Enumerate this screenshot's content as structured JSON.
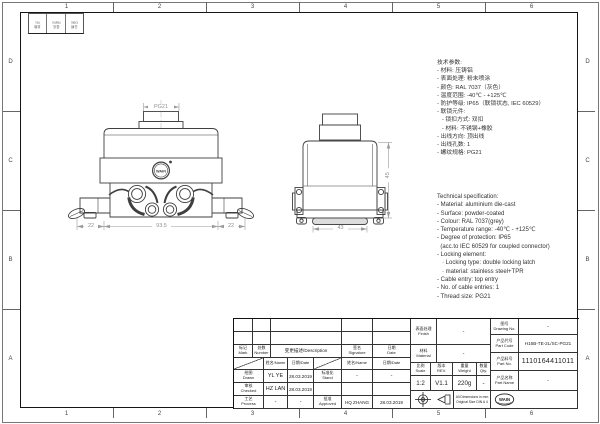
{
  "frame": {
    "columns": [
      "1",
      "2",
      "3",
      "4",
      "5",
      "6"
    ],
    "rows": [
      "D",
      "C",
      "B",
      "A"
    ]
  },
  "mini_table": {
    "cols": [
      "处数\nNo.",
      "签名\nName",
      "日期\nDate"
    ]
  },
  "drawing": {
    "front_view": {
      "thread_label": "PG21",
      "logo": "WAIN",
      "dim_left": "22",
      "dim_center": "93.5",
      "dim_right": "22"
    },
    "side_view": {
      "dim_height": "45",
      "dim_width": "43"
    }
  },
  "specs_cn": {
    "lines": [
      "技术参数:",
      "- 材料: 压铸铝",
      "- 表面处理: 粉末喷涂",
      "- 颜色: RAL 7037（灰色）",
      "- 温度范围: -40℃ - +125℃",
      "- 防护等级: IP65（联锁状态, IEC 60529）",
      "- 联锁元件:",
      "   - 锁扣方式: 双扣",
      "   - 材料: 不锈钢+橡胶",
      "- 出线方向: 顶出线",
      "- 出线孔数: 1",
      "- 螺纹规格: PG21"
    ]
  },
  "specs_en": {
    "lines": [
      "Technical specification:",
      "- Material: aluminium die-cast",
      "- Surface: powder-coated",
      "- Colour: RAL 7037(grey)",
      "- Temperature range: -40℃ - +125℃",
      "- Degree of protection: IP65",
      "  (acc.to IEC 60529 for coupled connector)",
      "- Locking element:",
      "   · Locking type: double locking latch",
      "   · material: stainless steel+TPR",
      "- Cable entry: top entry",
      "- No. of cable entries: 1",
      "- Thread size: PG21"
    ]
  },
  "title_block": {
    "revision": {
      "mark": "标记\nMark",
      "number": "处数\nNumber",
      "description": "变更描述/Description",
      "signature": "签名\nSignature",
      "date": "日期\nDate",
      "name_header": "姓名/Name",
      "date_header": "日期/Date"
    },
    "staff": {
      "drawn_label": "绘图\nDrawn",
      "drawn_name": "YL YE",
      "drawn_date": "28.03.2019",
      "stand_label": "标准化\nStand",
      "stand_name": "-",
      "stand_date": "-",
      "checked_label": "审核\nChecked",
      "checked_name": "HZ LAN",
      "checked_date": "28.03.2019",
      "process_label": "工艺\nProcess",
      "process_name": "-",
      "process_date": "-",
      "approved_label": "批准\nApproved",
      "approved_name": "HQ ZHANG",
      "approved_date": "28.03.2019"
    },
    "info": {
      "finish_label": "表面处理\nFinish",
      "finish_value": "-",
      "material_label": "材料\nMaterial",
      "material_value": "-",
      "scale_label": "比例\nScale",
      "scale_value": "1:2",
      "rev_label": "版本\nREV.",
      "rev_value": "V1.1",
      "weight_label": "重量\nWeight",
      "weight_value": "220g",
      "qty_label": "数量\nQty.",
      "qty_value": "-",
      "note": "All Dimensions in mm\nOriginal Size DIN A 4",
      "drawing_no_label": "图号\nDrawing No.",
      "drawing_no_value": "-",
      "part_code_label": "产品代号\nPart Code",
      "part_code_value": "H16B-TE-2L/SC-PG21",
      "part_no_label": "产品料号\nPart No.",
      "part_no_value": "1110164411011",
      "part_name_label": "产品名称\nPart Name",
      "part_name_value": "-"
    },
    "company": {
      "logo": "WAIN",
      "name_cn": "厦门唯恩电气有限公司",
      "name_en": "XIAMEN WAIN ELECTRICAL CO.LTD"
    }
  }
}
